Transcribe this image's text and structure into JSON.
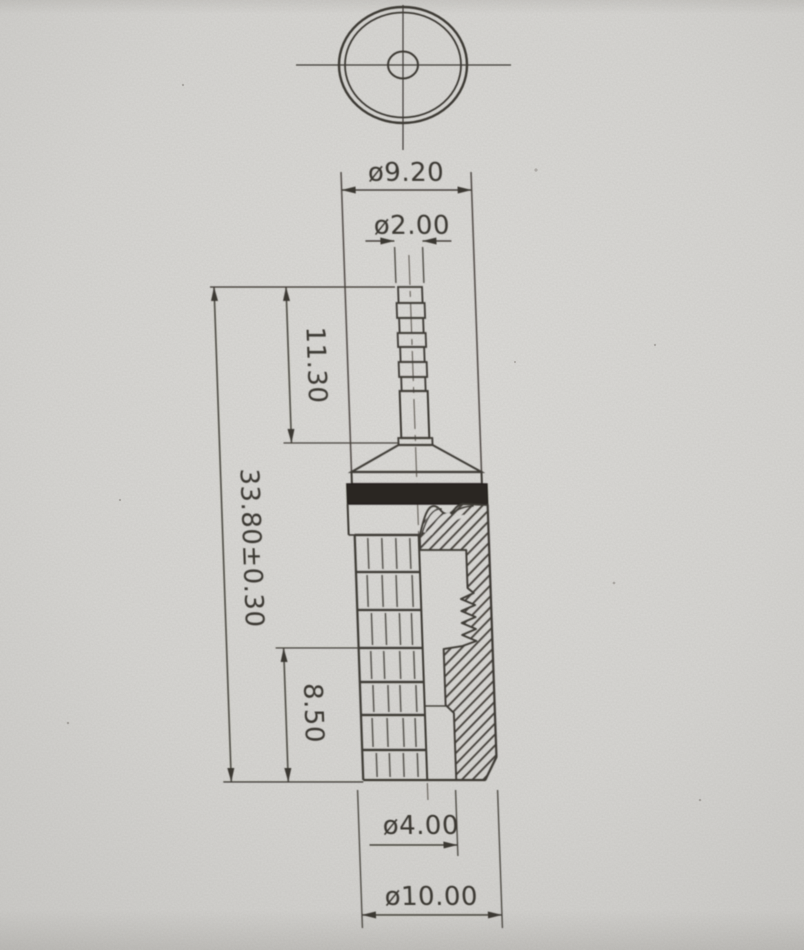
{
  "drawing": {
    "views": {
      "top_view": "circular end view",
      "side_view": "sectional side view"
    },
    "dimensions": {
      "outer_top": "ø9.20",
      "tip": "ø2.00",
      "tip_length": "11.30",
      "overall": "33.80±0.30",
      "lower": "8.50",
      "bore": "ø4.00",
      "body": "ø10.00"
    },
    "colors": {
      "paper": "#d7d6d3",
      "ink": "#3e3a35",
      "insulator_band": "#2a2723"
    }
  }
}
